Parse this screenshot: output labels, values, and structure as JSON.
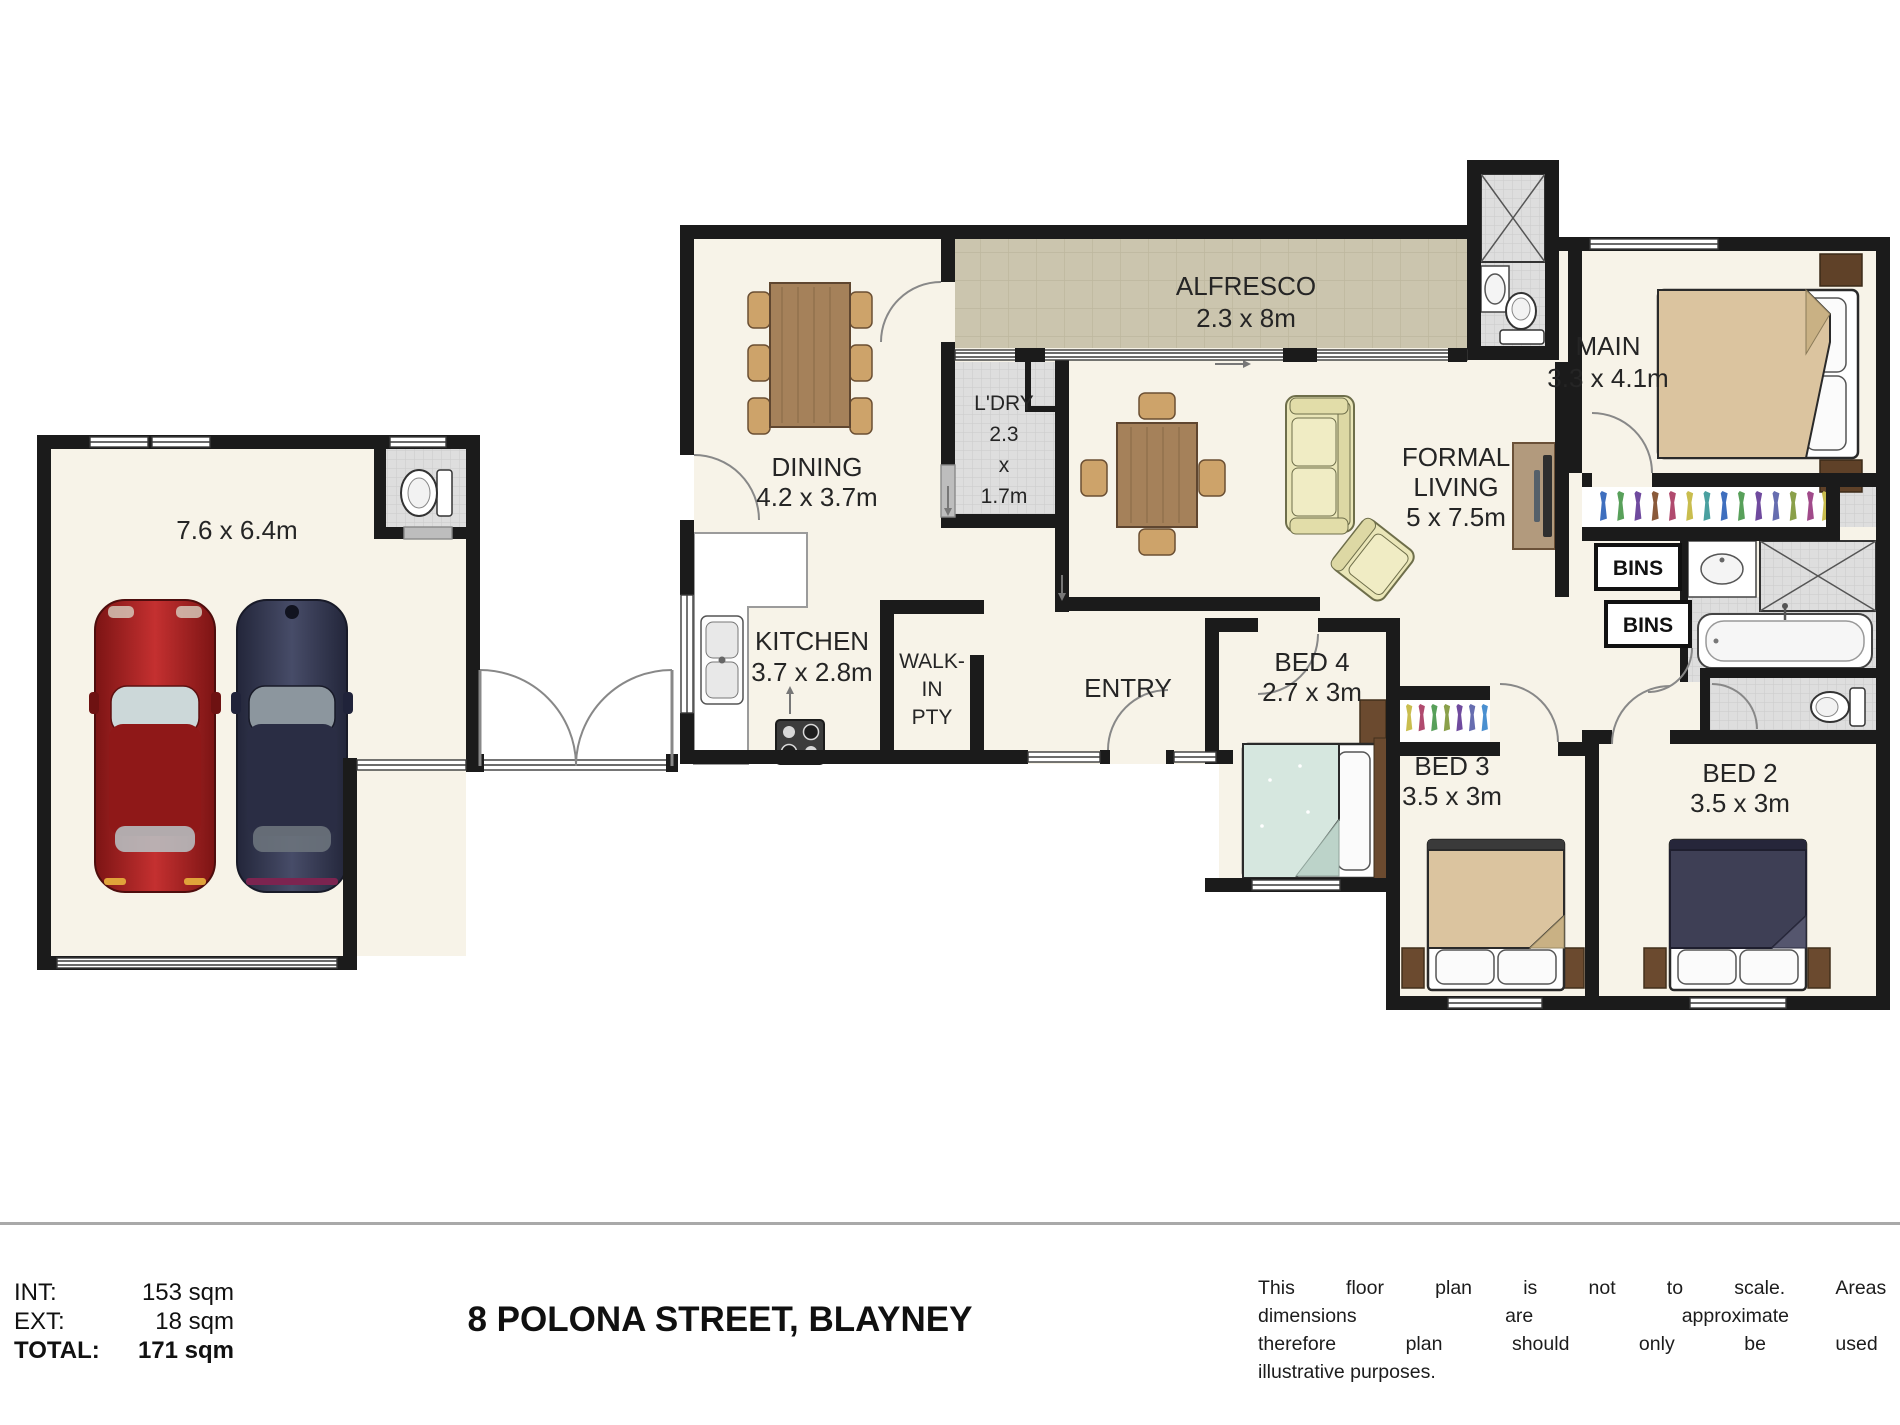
{
  "footer": {
    "title": "8 POLONA STREET, BLAYNEY",
    "int_label": "INT:",
    "int_value": "153 sqm",
    "ext_label": "EXT:",
    "ext_value": "18 sqm",
    "total_label": "TOTAL:",
    "total_value": "171 sqm",
    "disclaimer": [
      "This floor plan is not to scale. Areas and",
      "dimensions are approximate and",
      "therefore plan should only be used for",
      "illustrative purposes."
    ]
  },
  "rooms": {
    "garage": {
      "dims": "7.6 x 6.4m"
    },
    "dining": {
      "name": "DINING",
      "dims": "4.2 x 3.7m"
    },
    "alfresco": {
      "name": "ALFRESCO",
      "dims": "2.3 x 8m"
    },
    "laundry": {
      "l1": "L'DRY",
      "l2": "2.3",
      "l3": "x",
      "l4": "1.7m"
    },
    "kitchen": {
      "name": "KITCHEN",
      "dims": "3.7 x 2.8m"
    },
    "pantry": {
      "l1": "WALK-",
      "l2": "IN",
      "l3": "PTY"
    },
    "entry": {
      "name": "ENTRY"
    },
    "living": {
      "l1": "FORMAL",
      "l2": "LIVING",
      "dims": "5 x 7.5m"
    },
    "main": {
      "name": "MAIN",
      "dims": "3.3 x 4.1m"
    },
    "bed4": {
      "name": "BED 4",
      "dims": "2.7 x 3m"
    },
    "bed3": {
      "name": "BED 3",
      "dims": "3.5 x 3m"
    },
    "bed2": {
      "name": "BED 2",
      "dims": "3.5 x 3m"
    },
    "bins": {
      "label": "BINS"
    }
  },
  "colors": {
    "wall": "#1b1b1b",
    "floor_cream": "#f7f3e8",
    "tile_gray": "#dedede",
    "alfresco_beige": "#cbc5ae",
    "wood": "#a5815a",
    "chair": "#cda36a",
    "sofa": "#eae6b8",
    "bed_tan": "#dbc49f",
    "bed_teal": "#d6e7df",
    "bed_navy": "#3e3f55",
    "car_red": "#a82222",
    "car_navy": "#343850",
    "furn_brown": "#6b4a2f"
  }
}
